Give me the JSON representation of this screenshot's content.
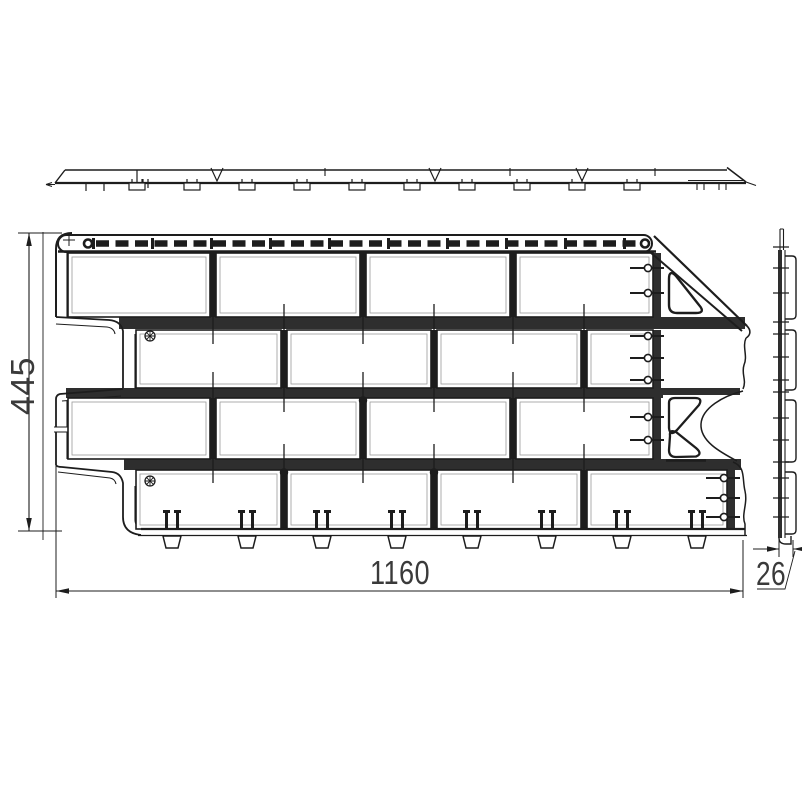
{
  "drawing": {
    "type": "technical-drawing",
    "subject": "facade-cladding-panel",
    "views": {
      "top": {
        "label": "top-profile-view"
      },
      "front": {
        "label": "front-view"
      },
      "side": {
        "label": "side-profile-view"
      }
    },
    "dimensions": {
      "height_mm": "445",
      "width_mm": "1160",
      "thickness_mm": "26"
    },
    "colors": {
      "ink": "#1d1d1d",
      "mortar_fill": "#2e2e2e",
      "paper": "#ffffff",
      "dim_text": "#3a3a3a"
    }
  }
}
